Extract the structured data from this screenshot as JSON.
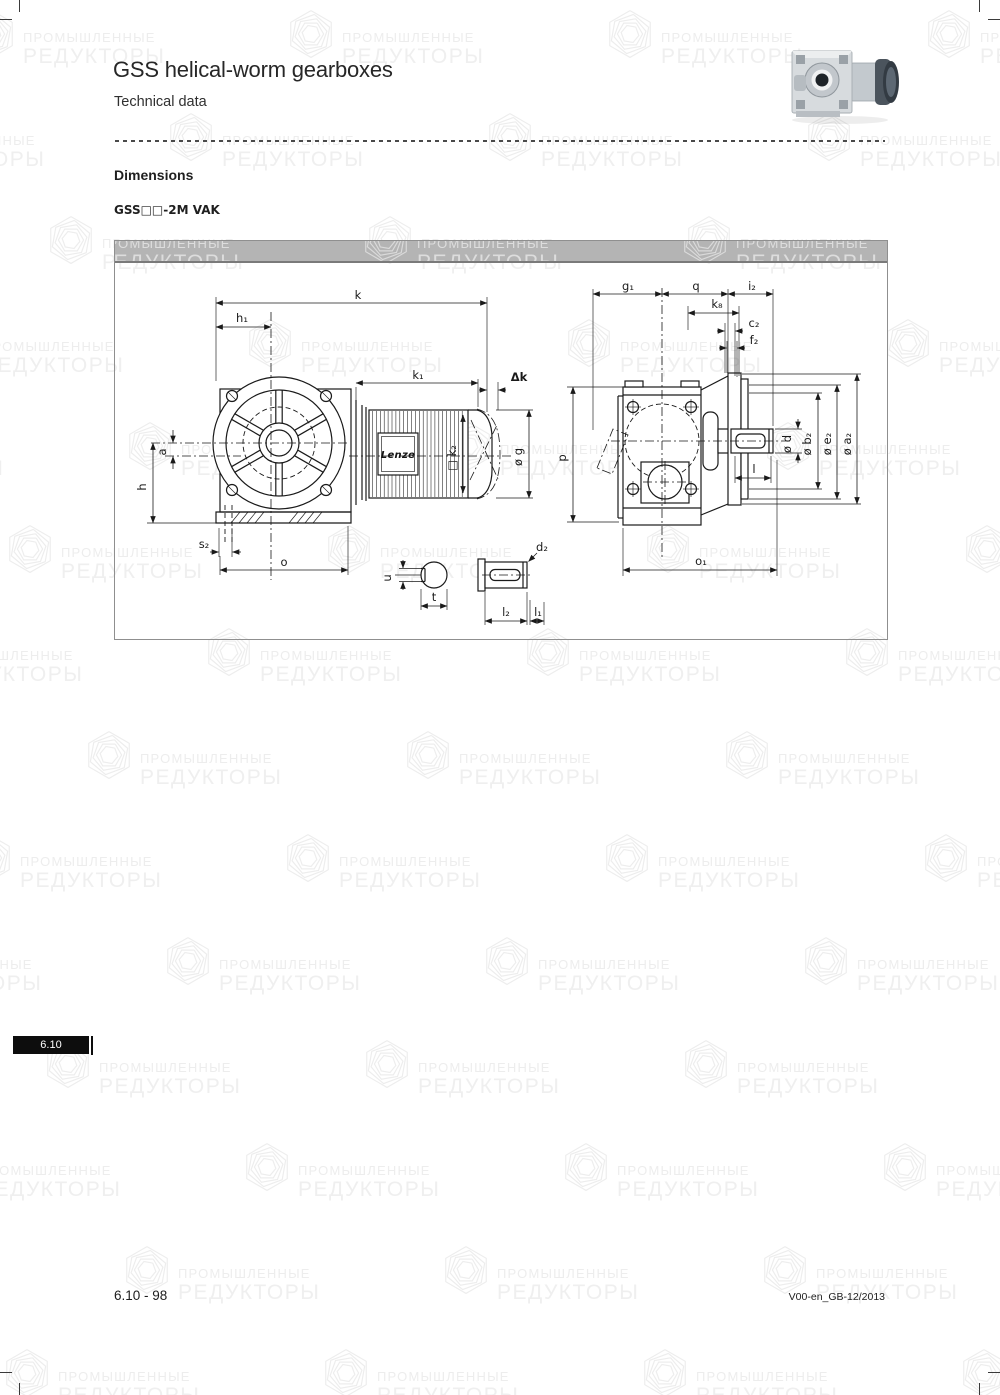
{
  "page": {
    "title": "GSS helical-worm gearboxes",
    "subtitle": "Technical data"
  },
  "section": {
    "heading": "Dimensions",
    "variant": "GSS□□-2M VAK"
  },
  "watermark": {
    "line1": "ПРОМЫШЛЕННЫЕ",
    "line2": "РЕДУКТОРЫ"
  },
  "drawing": {
    "brand": "Lenze",
    "labels": {
      "k": "k",
      "h1": "h₁",
      "k1": "k₁",
      "dk": "Δk",
      "a": "a",
      "h": "h",
      "s2": "s₂",
      "o": "o",
      "u": "u",
      "t": "t",
      "d2": "d₂",
      "l2": "l₂",
      "l1": "l₁",
      "k2": "□ k₂",
      "g": "ø g",
      "g1": "g₁",
      "q": "q",
      "i2": "i₂",
      "k8": "k₈",
      "c2": "c₂",
      "f2": "f₂",
      "d": "ø d",
      "b2": "ø b₂",
      "e2": "ø e₂",
      "a2": "ø a₂",
      "p": "p",
      "l": "l",
      "o1": "o₁"
    }
  },
  "tab": {
    "label": "6.10"
  },
  "footer": {
    "page_ref": "6.10 - 98",
    "doc_ref": "V00-en_GB-12/2013"
  },
  "colors": {
    "panel_bar": "#b4b4b4",
    "tab_bg": "#0d0d0d",
    "line": "#1a1a1a",
    "watermark": "#ededed"
  }
}
